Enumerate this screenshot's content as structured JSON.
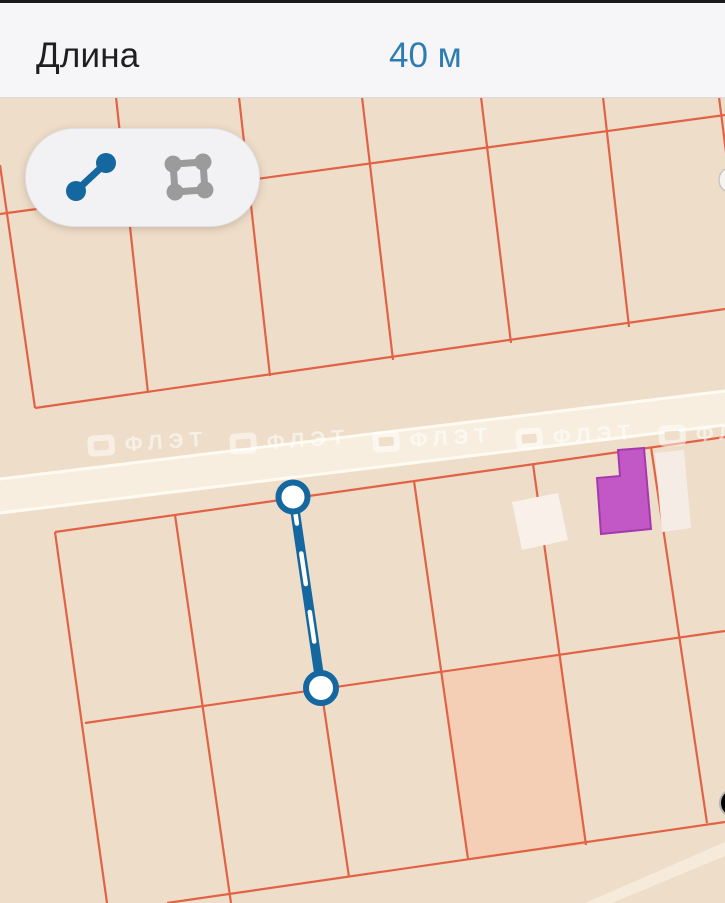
{
  "header": {
    "label": "Длина",
    "value": "40 м",
    "value_color": "#2e7db2"
  },
  "toolbar": {
    "tools": [
      {
        "name": "line-measure",
        "icon": "line-measure-icon",
        "active": true,
        "color": "#14679f"
      },
      {
        "name": "area-measure",
        "icon": "area-measure-icon",
        "active": false,
        "color": "#9b9b9b"
      }
    ]
  },
  "map": {
    "watermark_text": "ФЛЭТ",
    "measurement": {
      "type": "line",
      "endpoints": 2,
      "value": "40 м",
      "color": "#14679f"
    },
    "colors": {
      "background": "#eeddc9",
      "parcel_line": "#e0583a",
      "road_fill": "#f7eedf",
      "road_edge": "#fffcf4",
      "highlighted_parcel": "#f4cfb6",
      "building_purple": "#c158c6",
      "building_purple_border": "#a439ad",
      "building_white": "#f8f0e9"
    }
  }
}
